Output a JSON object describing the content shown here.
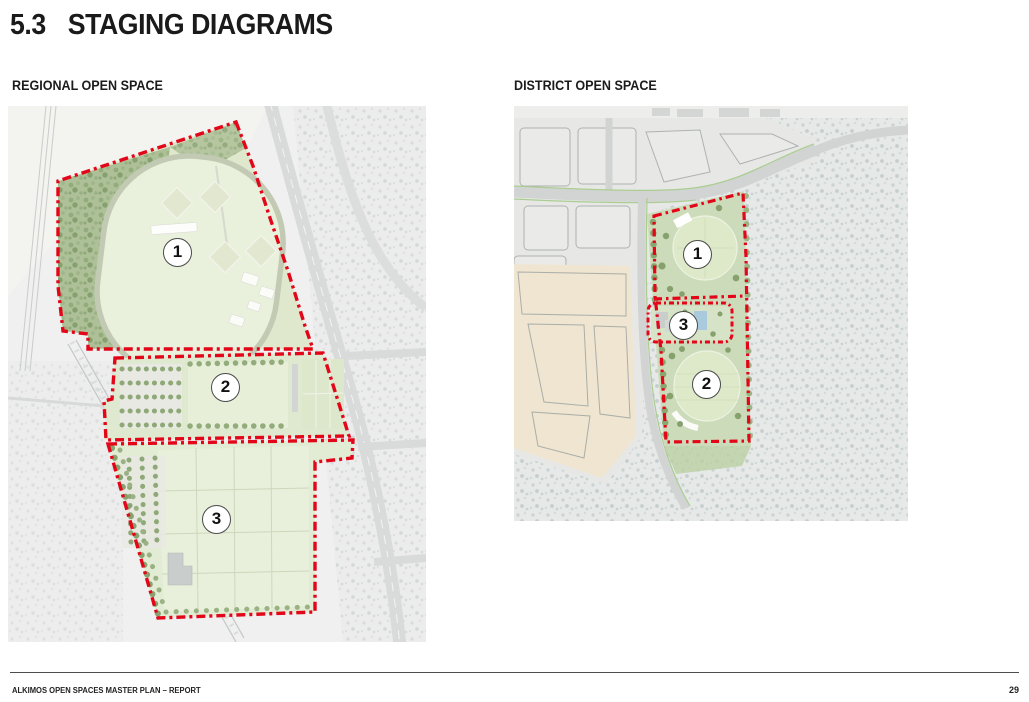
{
  "page": {
    "section_number": "5.3",
    "title": "STAGING DIAGRAMS"
  },
  "diagrams": [
    {
      "id": "regional-open-space",
      "label": "REGIONAL OPEN SPACE",
      "map_type": "aerial-staging-plan",
      "stages": [
        {
          "number": "1"
        },
        {
          "number": "2"
        },
        {
          "number": "3"
        }
      ]
    },
    {
      "id": "district-open-space",
      "label": "DISTRICT OPEN SPACE",
      "map_type": "aerial-staging-plan",
      "stages": [
        {
          "number": "1"
        },
        {
          "number": "3"
        },
        {
          "number": "2"
        }
      ]
    }
  ],
  "footer": {
    "left_text": "ALKIMOS OPEN SPACES MASTER PLAN – REPORT",
    "page_number": "29"
  },
  "colors": {
    "stage_boundary_red": "#e30619",
    "park_green": "#dce8c8",
    "bushland_green": "#a7bb91",
    "text_black": "#1a1a1a"
  }
}
